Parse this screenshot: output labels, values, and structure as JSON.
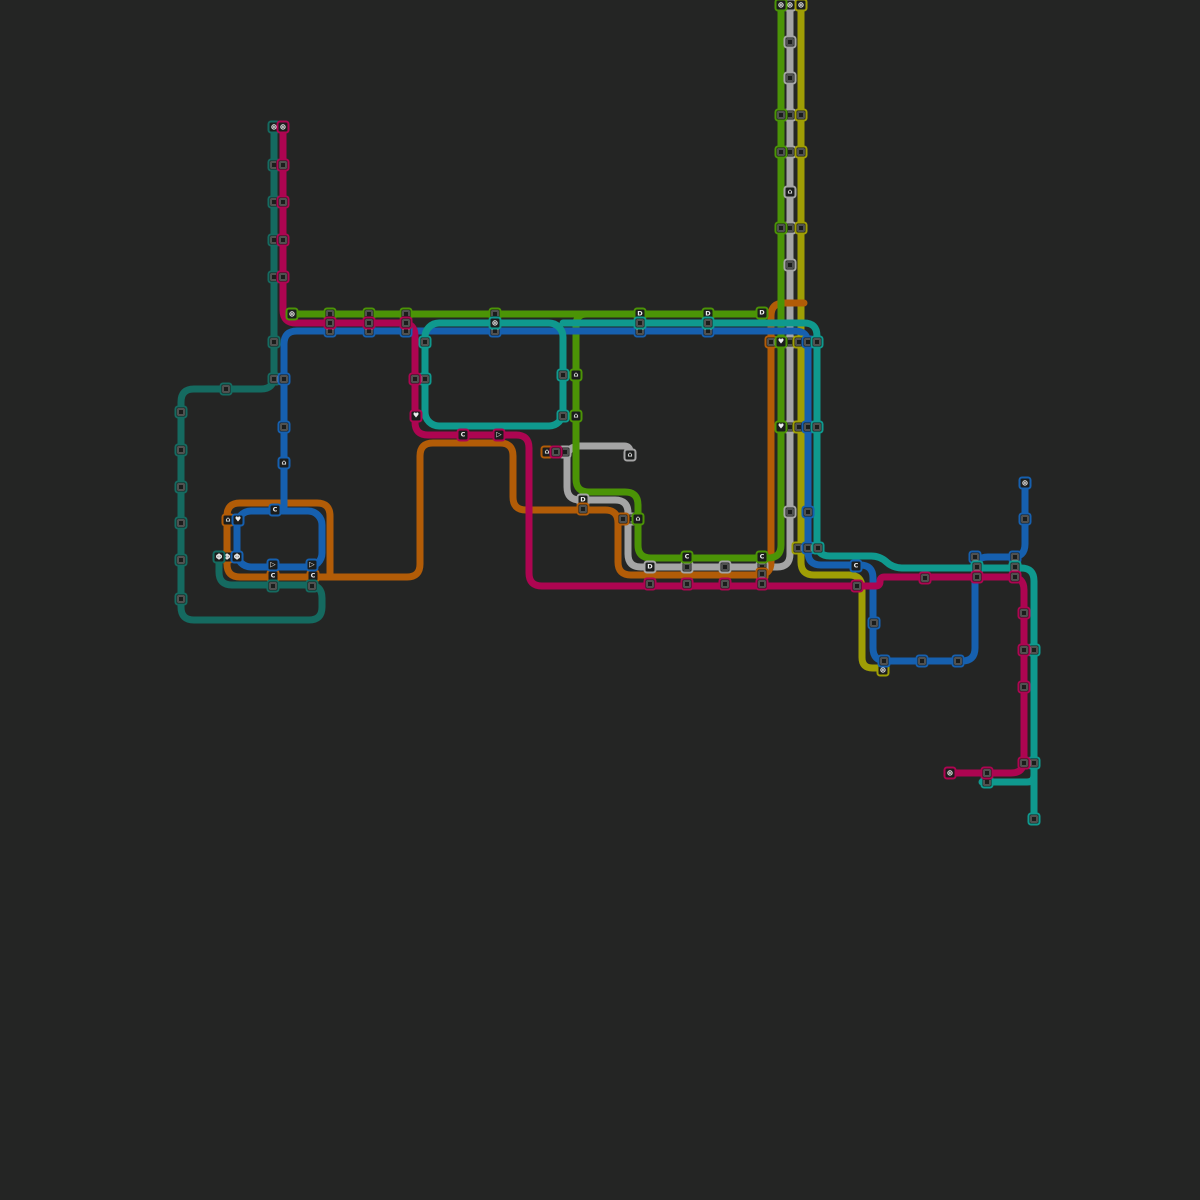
{
  "canvas": {
    "width": 1200,
    "height": 1200,
    "background": "#242524"
  },
  "style": {
    "line_width": 7,
    "corner_radius": 13,
    "station_size": 13,
    "station_fill": "#1b1d1c",
    "station_border_width": 2,
    "glyph_color": "#ededed"
  },
  "colors": {
    "gray": "#a5a5a5",
    "olive": "#9f9e05",
    "orange": "#b25c07",
    "green": "#4b9406",
    "teal_dark": "#156a60",
    "blue": "#1660af",
    "teal_bright": "#0f998e",
    "magenta": "#ad0551"
  },
  "lines": [
    {
      "name": "gray-line",
      "color": "gray",
      "paths": [
        [
          [
            790,
            5
          ],
          [
            790,
            567
          ],
          [
            628,
            567
          ],
          [
            628,
            500
          ],
          [
            567,
            500
          ],
          [
            567,
            446
          ],
          [
            630,
            446
          ],
          [
            630,
            458
          ]
        ]
      ]
    },
    {
      "name": "olive-line",
      "color": "olive",
      "paths": [
        [
          [
            801,
            5
          ],
          [
            801,
            575
          ],
          [
            862,
            575
          ],
          [
            862,
            668
          ],
          [
            883,
            668
          ]
        ]
      ]
    },
    {
      "name": "orange-line",
      "color": "orange",
      "paths": [
        [
          [
            804,
            303
          ],
          [
            771,
            303
          ],
          [
            771,
            575
          ],
          [
            618,
            575
          ],
          [
            618,
            510
          ],
          [
            513,
            510
          ],
          [
            513,
            443
          ],
          [
            420,
            443
          ],
          [
            420,
            577
          ],
          [
            227,
            577
          ],
          [
            227,
            503
          ],
          [
            330,
            503
          ],
          [
            330,
            577
          ]
        ]
      ]
    },
    {
      "name": "green-branch-line",
      "color": "green",
      "paths": [
        [
          [
            598,
            314
          ],
          [
            576,
            314
          ],
          [
            576,
            492
          ],
          [
            638,
            492
          ],
          [
            638,
            558
          ],
          [
            781,
            558
          ],
          [
            781,
            5
          ]
        ]
      ]
    },
    {
      "name": "green-crosstown-line",
      "color": "green",
      "paths": [
        [
          [
            292,
            314
          ],
          [
            762,
            314
          ]
        ]
      ]
    },
    {
      "name": "teal-dark-line",
      "color": "teal_dark",
      "paths": [
        [
          [
            274,
            127
          ],
          [
            274,
            389
          ],
          [
            181,
            389
          ],
          [
            181,
            620
          ],
          [
            322,
            620
          ],
          [
            322,
            585
          ],
          [
            219,
            585
          ],
          [
            219,
            557
          ]
        ]
      ]
    },
    {
      "name": "blue-line",
      "color": "blue",
      "paths": [
        [
          [
            1025,
            483
          ],
          [
            1025,
            557
          ],
          [
            975,
            557
          ],
          [
            975,
            661
          ],
          [
            873,
            661
          ],
          [
            873,
            565
          ],
          [
            808,
            565
          ],
          [
            808,
            331
          ],
          [
            284,
            331
          ],
          [
            284,
            511
          ]
        ]
      ],
      "rects": [
        [
          237,
          511,
          85,
          56
        ]
      ]
    },
    {
      "name": "teal-bright-line",
      "color": "teal_bright",
      "paths": [
        [
          [
            563,
            323
          ],
          [
            817,
            323
          ],
          [
            817,
            556
          ],
          [
            880,
            556
          ],
          [
            893,
            568
          ],
          [
            1034,
            568
          ],
          [
            1034,
            819
          ]
        ],
        [
          [
            982,
            782
          ],
          [
            1034,
            782
          ],
          [
            1034,
            768
          ]
        ]
      ],
      "rects": [
        [
          425,
          323,
          138,
          103
        ]
      ]
    },
    {
      "name": "magenta-line",
      "color": "magenta",
      "paths": [
        [
          [
            283,
            127
          ],
          [
            283,
            323
          ],
          [
            415,
            323
          ],
          [
            415,
            435
          ],
          [
            529,
            435
          ],
          [
            529,
            586
          ],
          [
            880,
            586
          ],
          [
            880,
            577
          ],
          [
            1024,
            577
          ],
          [
            1024,
            773
          ],
          [
            950,
            773
          ]
        ]
      ]
    }
  ],
  "stations": [
    {
      "x": 790,
      "y": 5,
      "line": "gray",
      "glyph": "flower"
    },
    {
      "x": 790,
      "y": 42,
      "line": "gray",
      "glyph": "sq"
    },
    {
      "x": 790,
      "y": 78,
      "line": "gray",
      "glyph": "sq"
    },
    {
      "x": 790,
      "y": 115,
      "line": "gray",
      "glyph": "sq"
    },
    {
      "x": 790,
      "y": 152,
      "line": "gray",
      "glyph": "sq"
    },
    {
      "x": 790,
      "y": 192,
      "line": "gray",
      "glyph": "home"
    },
    {
      "x": 790,
      "y": 228,
      "line": "gray",
      "glyph": "sq"
    },
    {
      "x": 790,
      "y": 265,
      "line": "gray",
      "glyph": "sq"
    },
    {
      "x": 790,
      "y": 342,
      "line": "gray",
      "glyph": "sq"
    },
    {
      "x": 790,
      "y": 427,
      "line": "gray",
      "glyph": "sq"
    },
    {
      "x": 790,
      "y": 512,
      "line": "gray",
      "glyph": "sq"
    },
    {
      "x": 762,
      "y": 567,
      "line": "gray",
      "glyph": "sq"
    },
    {
      "x": 725,
      "y": 567,
      "line": "gray",
      "glyph": "sq"
    },
    {
      "x": 687,
      "y": 567,
      "line": "gray",
      "glyph": "sq"
    },
    {
      "x": 650,
      "y": 567,
      "line": "gray",
      "glyph": "D"
    },
    {
      "x": 630,
      "y": 519,
      "line": "gray",
      "glyph": "sq"
    },
    {
      "x": 583,
      "y": 500,
      "line": "gray",
      "glyph": "D"
    },
    {
      "x": 565,
      "y": 452,
      "line": "gray",
      "glyph": "sq"
    },
    {
      "x": 630,
      "y": 455,
      "line": "gray",
      "glyph": "home"
    },
    {
      "x": 801,
      "y": 5,
      "line": "olive",
      "glyph": "flower"
    },
    {
      "x": 801,
      "y": 115,
      "line": "olive",
      "glyph": "sq"
    },
    {
      "x": 801,
      "y": 152,
      "line": "olive",
      "glyph": "sq"
    },
    {
      "x": 801,
      "y": 228,
      "line": "olive",
      "glyph": "sq"
    },
    {
      "x": 799,
      "y": 342,
      "line": "olive",
      "glyph": "sq"
    },
    {
      "x": 799,
      "y": 427,
      "line": "olive",
      "glyph": "sq"
    },
    {
      "x": 798,
      "y": 548,
      "line": "olive",
      "glyph": "sq"
    },
    {
      "x": 883,
      "y": 670,
      "line": "olive",
      "glyph": "flower"
    },
    {
      "x": 771,
      "y": 342,
      "line": "orange",
      "glyph": "sq"
    },
    {
      "x": 762,
      "y": 574,
      "line": "orange",
      "glyph": "sq"
    },
    {
      "x": 623,
      "y": 519,
      "line": "orange",
      "glyph": "sq"
    },
    {
      "x": 583,
      "y": 509,
      "line": "orange",
      "glyph": "sq"
    },
    {
      "x": 547,
      "y": 452,
      "line": "orange",
      "glyph": "home"
    },
    {
      "x": 313,
      "y": 576,
      "line": "orange",
      "glyph": "C"
    },
    {
      "x": 273,
      "y": 576,
      "line": "orange",
      "glyph": "C"
    },
    {
      "x": 227,
      "y": 557,
      "line": "orange",
      "glyph": "phi"
    },
    {
      "x": 228,
      "y": 520,
      "line": "orange",
      "glyph": "home"
    },
    {
      "x": 781,
      "y": 5,
      "line": "green",
      "glyph": "flower"
    },
    {
      "x": 781,
      "y": 115,
      "line": "green",
      "glyph": "sq"
    },
    {
      "x": 781,
      "y": 152,
      "line": "green",
      "glyph": "sq"
    },
    {
      "x": 781,
      "y": 228,
      "line": "green",
      "glyph": "sq"
    },
    {
      "x": 781,
      "y": 342,
      "line": "green",
      "glyph": "heart"
    },
    {
      "x": 781,
      "y": 427,
      "line": "green",
      "glyph": "heart"
    },
    {
      "x": 762,
      "y": 557,
      "line": "green",
      "glyph": "C"
    },
    {
      "x": 687,
      "y": 557,
      "line": "green",
      "glyph": "C"
    },
    {
      "x": 638,
      "y": 519,
      "line": "green",
      "glyph": "home"
    },
    {
      "x": 576,
      "y": 416,
      "line": "green",
      "glyph": "home"
    },
    {
      "x": 576,
      "y": 375,
      "line": "green",
      "glyph": "home"
    },
    {
      "x": 292,
      "y": 314,
      "line": "green",
      "glyph": "flower"
    },
    {
      "x": 330,
      "y": 314,
      "line": "green",
      "glyph": "sq"
    },
    {
      "x": 369,
      "y": 314,
      "line": "green",
      "glyph": "sq"
    },
    {
      "x": 406,
      "y": 314,
      "line": "green",
      "glyph": "sq"
    },
    {
      "x": 495,
      "y": 314,
      "line": "green",
      "glyph": "sq"
    },
    {
      "x": 640,
      "y": 314,
      "line": "green",
      "glyph": "D"
    },
    {
      "x": 708,
      "y": 314,
      "line": "green",
      "glyph": "D"
    },
    {
      "x": 762,
      "y": 313,
      "line": "green",
      "glyph": "D"
    },
    {
      "x": 274,
      "y": 127,
      "line": "teal_dark",
      "glyph": "flower"
    },
    {
      "x": 274,
      "y": 165,
      "line": "teal_dark",
      "glyph": "sq"
    },
    {
      "x": 274,
      "y": 202,
      "line": "teal_dark",
      "glyph": "sq"
    },
    {
      "x": 274,
      "y": 240,
      "line": "teal_dark",
      "glyph": "sq"
    },
    {
      "x": 274,
      "y": 277,
      "line": "teal_dark",
      "glyph": "sq"
    },
    {
      "x": 274,
      "y": 342,
      "line": "teal_dark",
      "glyph": "sq"
    },
    {
      "x": 274,
      "y": 379,
      "line": "teal_dark",
      "glyph": "sq"
    },
    {
      "x": 226,
      "y": 389,
      "line": "teal_dark",
      "glyph": "sq"
    },
    {
      "x": 181,
      "y": 412,
      "line": "teal_dark",
      "glyph": "sq"
    },
    {
      "x": 181,
      "y": 450,
      "line": "teal_dark",
      "glyph": "sq"
    },
    {
      "x": 181,
      "y": 487,
      "line": "teal_dark",
      "glyph": "sq"
    },
    {
      "x": 181,
      "y": 523,
      "line": "teal_dark",
      "glyph": "sq"
    },
    {
      "x": 181,
      "y": 560,
      "line": "teal_dark",
      "glyph": "sq"
    },
    {
      "x": 181,
      "y": 599,
      "line": "teal_dark",
      "glyph": "sq"
    },
    {
      "x": 312,
      "y": 586,
      "line": "teal_dark",
      "glyph": "sq"
    },
    {
      "x": 273,
      "y": 586,
      "line": "teal_dark",
      "glyph": "sq"
    },
    {
      "x": 219,
      "y": 557,
      "line": "teal_dark",
      "glyph": "phi"
    },
    {
      "x": 1025,
      "y": 483,
      "line": "blue",
      "glyph": "flower"
    },
    {
      "x": 1025,
      "y": 519,
      "line": "blue",
      "glyph": "sq"
    },
    {
      "x": 1015,
      "y": 557,
      "line": "blue",
      "glyph": "sq"
    },
    {
      "x": 975,
      "y": 557,
      "line": "blue",
      "glyph": "sq"
    },
    {
      "x": 958,
      "y": 661,
      "line": "blue",
      "glyph": "sq"
    },
    {
      "x": 922,
      "y": 661,
      "line": "blue",
      "glyph": "sq"
    },
    {
      "x": 884,
      "y": 661,
      "line": "blue",
      "glyph": "sq"
    },
    {
      "x": 874,
      "y": 623,
      "line": "blue",
      "glyph": "sq"
    },
    {
      "x": 856,
      "y": 566,
      "line": "blue",
      "glyph": "C"
    },
    {
      "x": 808,
      "y": 548,
      "line": "blue",
      "glyph": "sq"
    },
    {
      "x": 808,
      "y": 512,
      "line": "blue",
      "glyph": "sq"
    },
    {
      "x": 808,
      "y": 427,
      "line": "blue",
      "glyph": "sq"
    },
    {
      "x": 808,
      "y": 342,
      "line": "blue",
      "glyph": "sq"
    },
    {
      "x": 708,
      "y": 331,
      "line": "blue",
      "glyph": "sq"
    },
    {
      "x": 640,
      "y": 331,
      "line": "blue",
      "glyph": "sq"
    },
    {
      "x": 495,
      "y": 331,
      "line": "blue",
      "glyph": "sq"
    },
    {
      "x": 406,
      "y": 331,
      "line": "blue",
      "glyph": "sq"
    },
    {
      "x": 369,
      "y": 331,
      "line": "blue",
      "glyph": "sq"
    },
    {
      "x": 330,
      "y": 331,
      "line": "blue",
      "glyph": "sq"
    },
    {
      "x": 284,
      "y": 379,
      "line": "blue",
      "glyph": "sq"
    },
    {
      "x": 284,
      "y": 427,
      "line": "blue",
      "glyph": "sq"
    },
    {
      "x": 284,
      "y": 463,
      "line": "blue",
      "glyph": "home"
    },
    {
      "x": 275,
      "y": 510,
      "line": "blue",
      "glyph": "C"
    },
    {
      "x": 238,
      "y": 520,
      "line": "blue",
      "glyph": "heart"
    },
    {
      "x": 237,
      "y": 557,
      "line": "blue",
      "glyph": "phi"
    },
    {
      "x": 273,
      "y": 565,
      "line": "blue",
      "glyph": "tri"
    },
    {
      "x": 312,
      "y": 565,
      "line": "blue",
      "glyph": "tri"
    },
    {
      "x": 495,
      "y": 323,
      "line": "teal_bright",
      "glyph": "flower"
    },
    {
      "x": 425,
      "y": 342,
      "line": "teal_bright",
      "glyph": "sq"
    },
    {
      "x": 425,
      "y": 379,
      "line": "teal_bright",
      "glyph": "sq"
    },
    {
      "x": 563,
      "y": 375,
      "line": "teal_bright",
      "glyph": "sq"
    },
    {
      "x": 563,
      "y": 416,
      "line": "teal_bright",
      "glyph": "sq"
    },
    {
      "x": 640,
      "y": 323,
      "line": "teal_bright",
      "glyph": "sq"
    },
    {
      "x": 708,
      "y": 323,
      "line": "teal_bright",
      "glyph": "sq"
    },
    {
      "x": 817,
      "y": 342,
      "line": "teal_bright",
      "glyph": "sq"
    },
    {
      "x": 817,
      "y": 427,
      "line": "teal_bright",
      "glyph": "sq"
    },
    {
      "x": 818,
      "y": 548,
      "line": "teal_bright",
      "glyph": "sq"
    },
    {
      "x": 977,
      "y": 567,
      "line": "teal_bright",
      "glyph": "sq"
    },
    {
      "x": 1015,
      "y": 567,
      "line": "teal_bright",
      "glyph": "sq"
    },
    {
      "x": 1034,
      "y": 650,
      "line": "teal_bright",
      "glyph": "sq"
    },
    {
      "x": 1034,
      "y": 763,
      "line": "teal_bright",
      "glyph": "sq"
    },
    {
      "x": 987,
      "y": 782,
      "line": "teal_bright",
      "glyph": "sq"
    },
    {
      "x": 1034,
      "y": 819,
      "line": "teal_bright",
      "glyph": "sq"
    },
    {
      "x": 283,
      "y": 127,
      "line": "magenta",
      "glyph": "flower"
    },
    {
      "x": 283,
      "y": 165,
      "line": "magenta",
      "glyph": "sq"
    },
    {
      "x": 283,
      "y": 202,
      "line": "magenta",
      "glyph": "sq"
    },
    {
      "x": 283,
      "y": 240,
      "line": "magenta",
      "glyph": "sq"
    },
    {
      "x": 283,
      "y": 277,
      "line": "magenta",
      "glyph": "sq"
    },
    {
      "x": 330,
      "y": 323,
      "line": "magenta",
      "glyph": "sq"
    },
    {
      "x": 369,
      "y": 323,
      "line": "magenta",
      "glyph": "sq"
    },
    {
      "x": 406,
      "y": 323,
      "line": "magenta",
      "glyph": "sq"
    },
    {
      "x": 415,
      "y": 379,
      "line": "magenta",
      "glyph": "sq"
    },
    {
      "x": 416,
      "y": 416,
      "line": "magenta",
      "glyph": "heart"
    },
    {
      "x": 463,
      "y": 435,
      "line": "magenta",
      "glyph": "C"
    },
    {
      "x": 499,
      "y": 435,
      "line": "magenta",
      "glyph": "tri"
    },
    {
      "x": 556,
      "y": 452,
      "line": "magenta",
      "glyph": "sq"
    },
    {
      "x": 650,
      "y": 584,
      "line": "magenta",
      "glyph": "sq"
    },
    {
      "x": 687,
      "y": 584,
      "line": "magenta",
      "glyph": "sq"
    },
    {
      "x": 725,
      "y": 584,
      "line": "magenta",
      "glyph": "sq"
    },
    {
      "x": 762,
      "y": 584,
      "line": "magenta",
      "glyph": "sq"
    },
    {
      "x": 857,
      "y": 586,
      "line": "magenta",
      "glyph": "sq"
    },
    {
      "x": 925,
      "y": 578,
      "line": "magenta",
      "glyph": "sq"
    },
    {
      "x": 977,
      "y": 577,
      "line": "magenta",
      "glyph": "sq"
    },
    {
      "x": 1015,
      "y": 577,
      "line": "magenta",
      "glyph": "sq"
    },
    {
      "x": 1024,
      "y": 613,
      "line": "magenta",
      "glyph": "sq"
    },
    {
      "x": 1024,
      "y": 650,
      "line": "magenta",
      "glyph": "sq"
    },
    {
      "x": 1024,
      "y": 687,
      "line": "magenta",
      "glyph": "sq"
    },
    {
      "x": 1024,
      "y": 763,
      "line": "magenta",
      "glyph": "sq"
    },
    {
      "x": 987,
      "y": 773,
      "line": "magenta",
      "glyph": "sq"
    },
    {
      "x": 950,
      "y": 773,
      "line": "magenta",
      "glyph": "flower"
    }
  ]
}
